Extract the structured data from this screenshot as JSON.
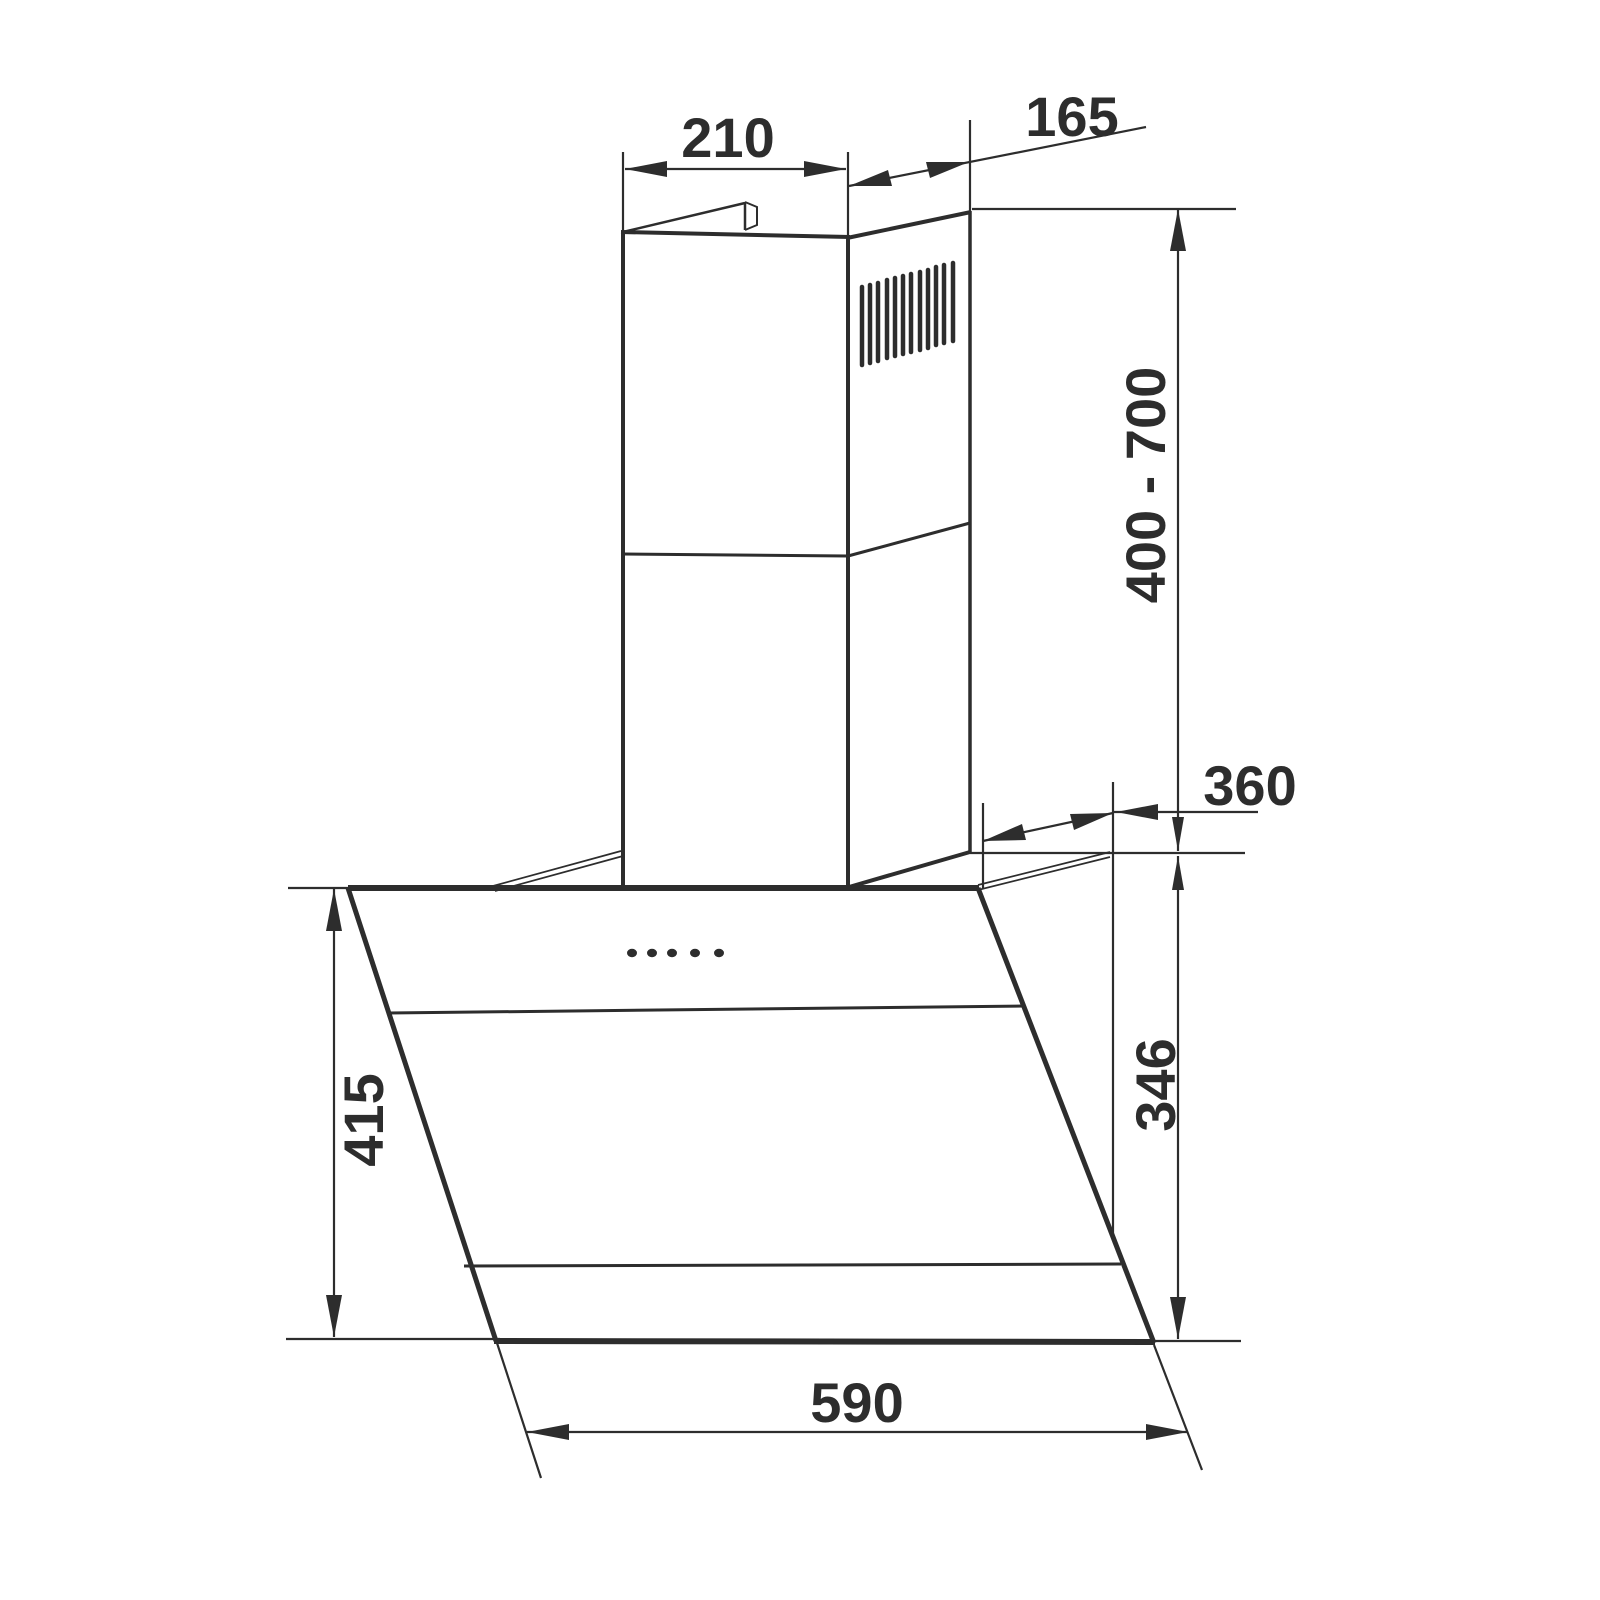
{
  "drawing": {
    "subject": "wall-mounted angled cooker hood dimension drawing",
    "background_color": "#ffffff",
    "line_color": "#2d2d2d",
    "labels": {
      "chimney_width": "210",
      "chimney_depth": "165",
      "chimney_height_range": "400 - 700",
      "top_mounting_depth": "360",
      "back_height": "346",
      "front_glass_height": "415",
      "hood_width": "590"
    },
    "features": {
      "control_dots": 5,
      "grille_slats": 12
    }
  }
}
